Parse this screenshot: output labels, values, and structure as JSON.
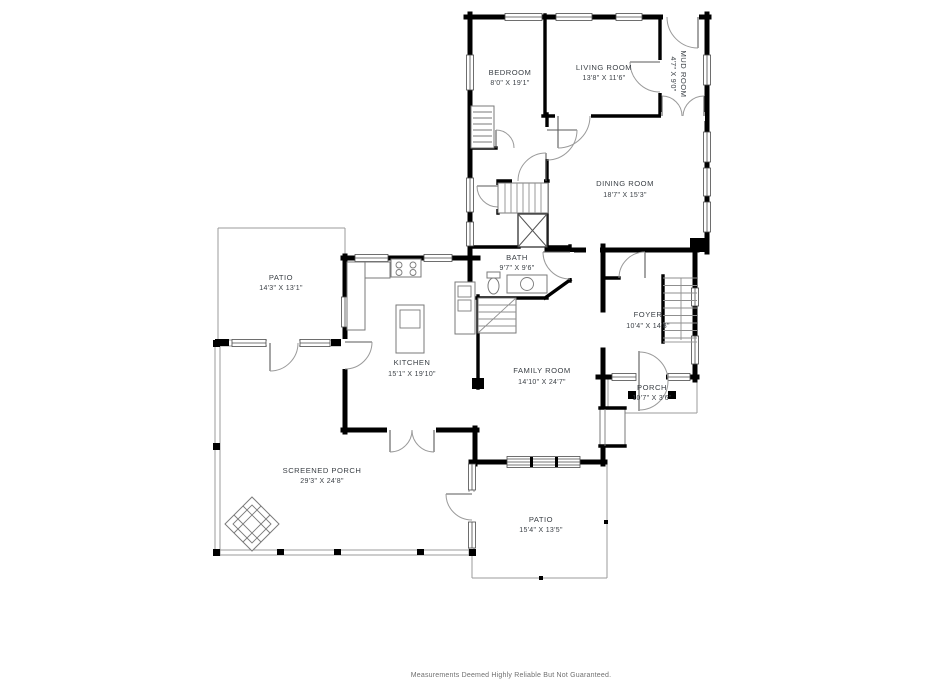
{
  "meta": {
    "type": "residential-floor-plan",
    "colors": {
      "background": "#ffffff",
      "wall": "#000000",
      "thin_line": "#9b9b9b",
      "label": "#3b4046"
    }
  },
  "rooms": {
    "bedroom": {
      "name": "BEDROOM",
      "dims": "8'0\" X 19'1\""
    },
    "living_room": {
      "name": "LIVING ROOM",
      "dims": "13'8\" X 11'6\""
    },
    "mud_room": {
      "name": "MUD ROOM",
      "dims": "4'7\" X 9'0\""
    },
    "dining_room": {
      "name": "DINING ROOM",
      "dims": "18'7\" X 15'3\""
    },
    "bath": {
      "name": "BATH",
      "dims": "9'7\" X 9'6\""
    },
    "kitchen": {
      "name": "KITCHEN",
      "dims": "15'1\" X 19'10\""
    },
    "family_room": {
      "name": "FAMILY ROOM",
      "dims": "14'10\" X 24'7\""
    },
    "foyer": {
      "name": "FOYER",
      "dims": "10'4\" X 14'8\""
    },
    "porch": {
      "name": "PORCH",
      "dims": "10'7\" X 3'6\""
    },
    "patio_upper": {
      "name": "PATIO",
      "dims": "14'3\" X 13'1\""
    },
    "screened_porch": {
      "name": "SCREENED PORCH",
      "dims": "29'3\" X 24'8\""
    },
    "patio_lower": {
      "name": "PATIO",
      "dims": "15'4\" X 13'5\""
    }
  },
  "footer": {
    "text": "Measurements Deemed Highly Reliable But Not Guaranteed."
  }
}
